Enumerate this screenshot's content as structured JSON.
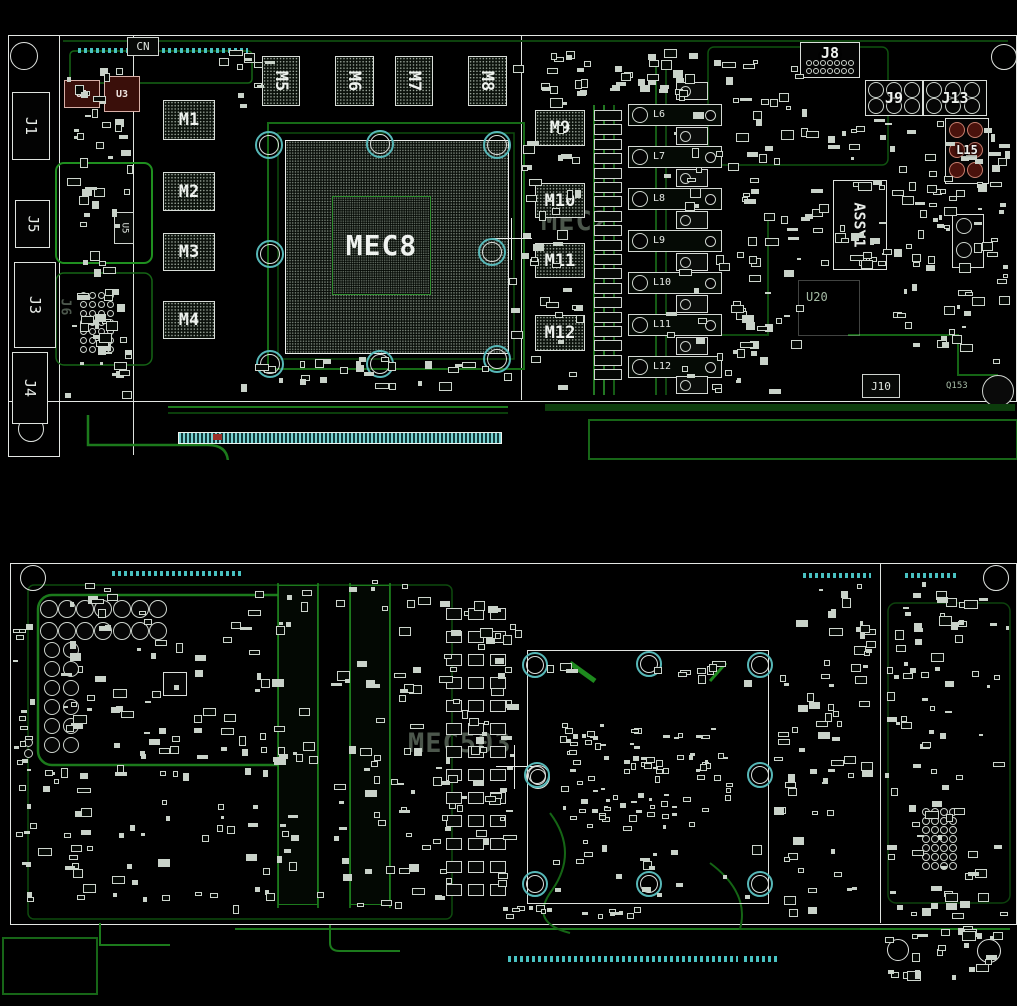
{
  "drawing": {
    "type": "pcb-assembly-drawing"
  },
  "palette": {
    "background": "#000000",
    "board_outline": "#e3e6e3",
    "silkscreen_white": "#d7ded7",
    "trace_green": "#1c7a1c",
    "trace_dark_green": "#0d4210",
    "pad_teal": "#49c2c2",
    "cap_red": "#4a120c",
    "ghost_text": "#97ad97"
  },
  "top": {
    "labels": {
      "cn": "CN",
      "u1": "U1",
      "u3": "U3",
      "u5": "U5",
      "j1": "J1",
      "j5": "J5",
      "j3": "J3",
      "j4": "J4",
      "j6": "J6",
      "gpu": "MEC8",
      "ghost": "MEC2",
      "j8": "J8",
      "j9": "J9",
      "j13": "J13",
      "l15": "L15",
      "assy": "ASSY1",
      "u20": "U20",
      "j10": "J10",
      "q153": "Q153"
    },
    "memory_left": [
      "M1",
      "M2",
      "M3",
      "M4"
    ],
    "memory_top": [
      "M5",
      "M6",
      "M7",
      "M8"
    ],
    "memory_right": [
      "M9",
      "M10",
      "M11",
      "M12"
    ],
    "inductors": [
      "L6",
      "L7",
      "L8",
      "L9",
      "L10",
      "L11",
      "L12"
    ]
  },
  "bottom": {
    "labels": {
      "ghost": "MEC503"
    }
  }
}
